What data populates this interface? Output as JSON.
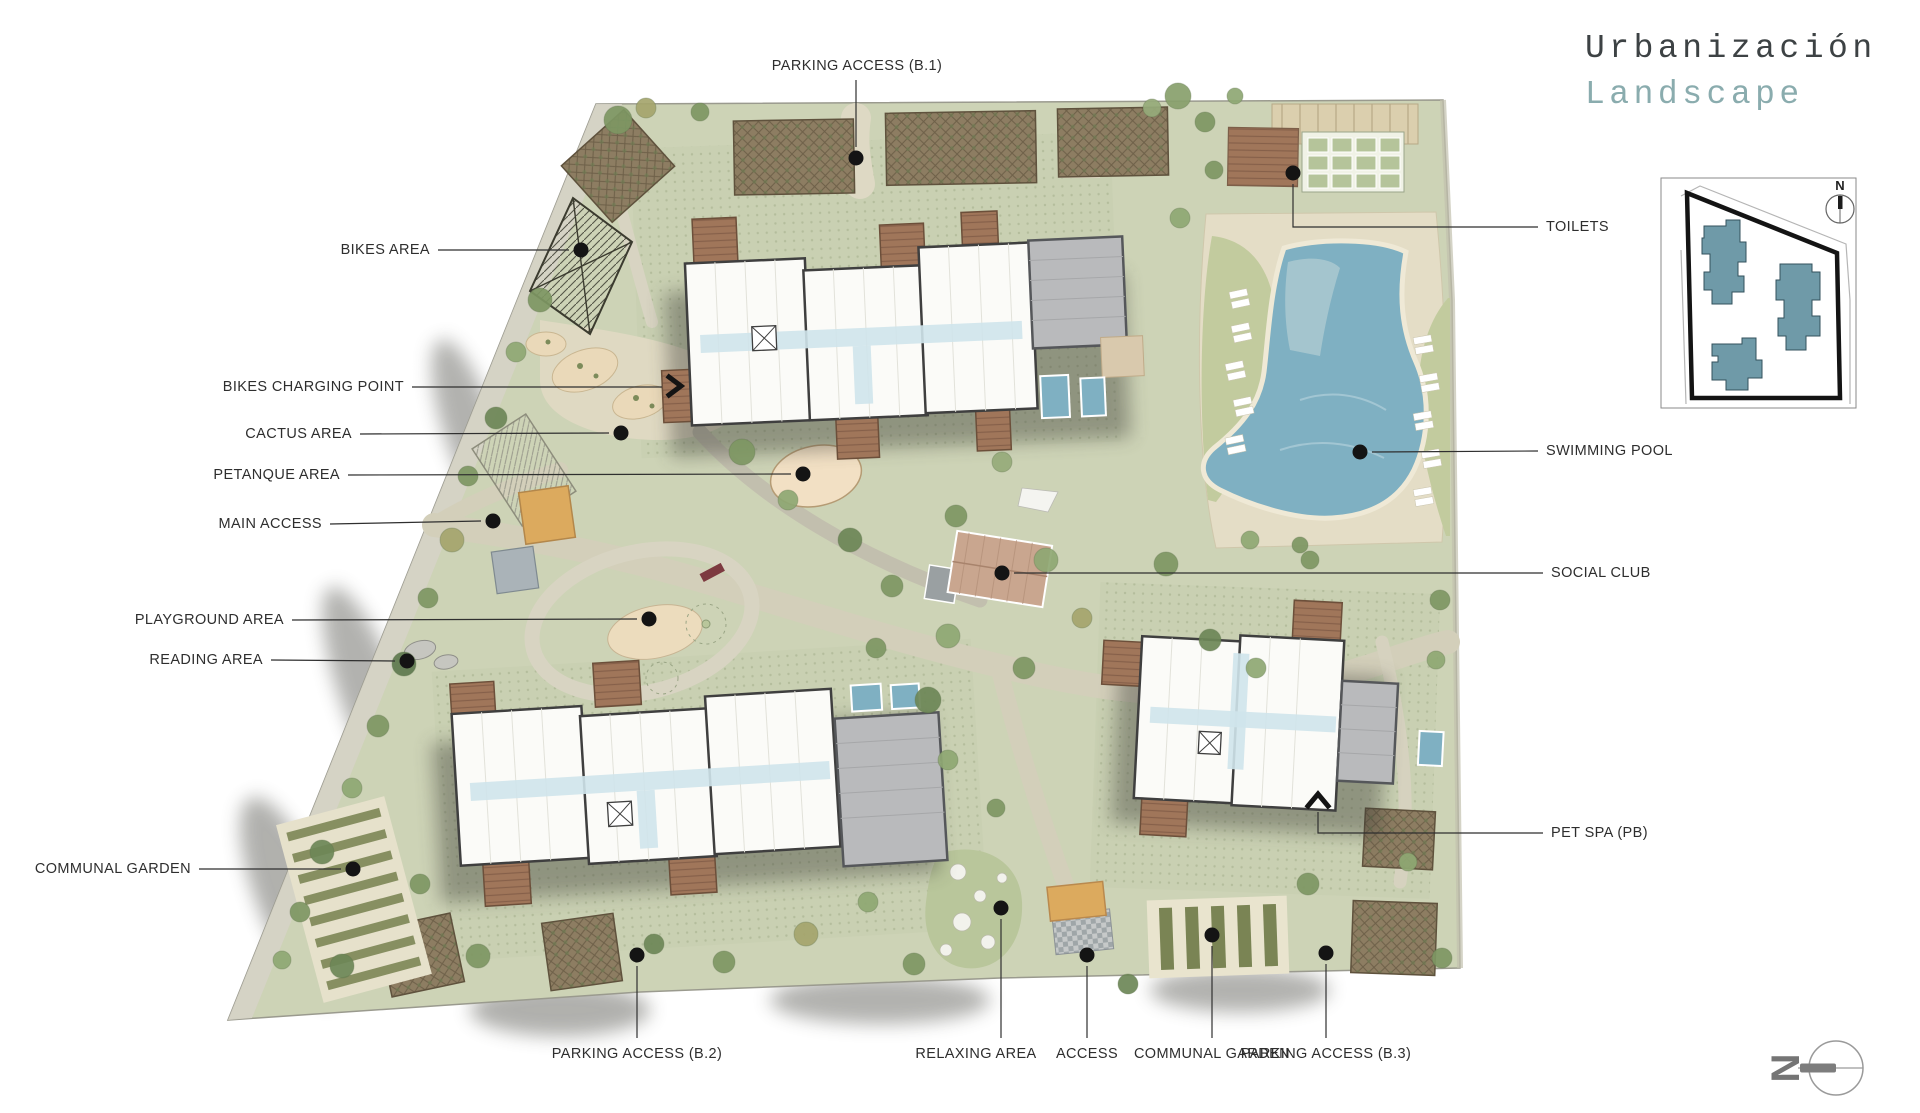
{
  "title": {
    "line1": "Urbanización",
    "line2": "Landscape"
  },
  "palette": {
    "label_color": "#2e2e2e",
    "title_dark": "#3d4244",
    "title_teal": "#8aacae",
    "site_green": "#cdd3b6",
    "lawn": "#c2cb9e",
    "path_beige": "#d8d4c0",
    "pool_blue": "#7fb0c2",
    "building_fill": "#fbfbf8",
    "building_stroke": "#3f3f3f",
    "roof_gray": "#b9babc",
    "terrace_brown": "#9b7258",
    "access_orange": "#dcaa5e",
    "inset_building_teal": "#6f9aa8"
  },
  "inset": {
    "north_label": "N"
  },
  "compass": {
    "north_label": "N"
  },
  "callouts": [
    {
      "id": "parking-access-b1",
      "text": "PARKING ACCESS (B.1)",
      "align": "center",
      "label": [
        857,
        66
      ],
      "line": [
        [
          856,
          80
        ],
        [
          856,
          147
        ]
      ],
      "dot": [
        856,
        158
      ]
    },
    {
      "id": "bikes-area",
      "text": "BIKES AREA",
      "align": "right",
      "label": [
        430,
        250
      ],
      "line": [
        [
          438,
          250
        ],
        [
          569,
          250
        ]
      ],
      "dot": [
        581,
        250
      ]
    },
    {
      "id": "bikes-charging-point",
      "text": "BIKES CHARGING POINT",
      "align": "right",
      "label": [
        404,
        387
      ],
      "line": [
        [
          412,
          387
        ],
        [
          662,
          387
        ]
      ],
      "marker": {
        "type": "chevron-right",
        "x": 676,
        "y": 386
      }
    },
    {
      "id": "cactus-area",
      "text": "CACTUS AREA",
      "align": "right",
      "label": [
        352,
        434
      ],
      "line": [
        [
          360,
          434
        ],
        [
          609,
          433
        ]
      ],
      "dot": [
        621,
        433
      ]
    },
    {
      "id": "petanque-area",
      "text": "PETANQUE AREA",
      "align": "right",
      "label": [
        340,
        475
      ],
      "line": [
        [
          348,
          475
        ],
        [
          791,
          474
        ]
      ],
      "dot": [
        803,
        474
      ]
    },
    {
      "id": "main-access",
      "text": "MAIN ACCESS",
      "align": "right",
      "label": [
        322,
        524
      ],
      "line": [
        [
          330,
          524
        ],
        [
          481,
          521
        ]
      ],
      "dot": [
        493,
        521
      ]
    },
    {
      "id": "playground-area",
      "text": "PLAYGROUND AREA",
      "align": "right",
      "label": [
        284,
        620
      ],
      "line": [
        [
          292,
          620
        ],
        [
          637,
          619
        ]
      ],
      "dot": [
        649,
        619
      ]
    },
    {
      "id": "reading-area",
      "text": "READING AREA",
      "align": "right",
      "label": [
        263,
        660
      ],
      "line": [
        [
          271,
          660
        ],
        [
          395,
          661
        ]
      ],
      "dot": [
        407,
        661
      ]
    },
    {
      "id": "communal-garden-left",
      "text": "COMMUNAL GARDEN",
      "align": "right",
      "label": [
        191,
        869
      ],
      "line": [
        [
          199,
          869
        ],
        [
          341,
          869
        ]
      ],
      "dot": [
        353,
        869
      ]
    },
    {
      "id": "toilets",
      "text": "TOILETS",
      "align": "left",
      "label": [
        1546,
        227
      ],
      "line": [
        [
          1293,
          184
        ],
        [
          1293,
          227
        ],
        [
          1538,
          227
        ]
      ],
      "dot": [
        1293,
        173
      ]
    },
    {
      "id": "swimming-pool",
      "text": "SWIMMING POOL",
      "align": "left",
      "label": [
        1546,
        451
      ],
      "line": [
        [
          1372,
          452
        ],
        [
          1538,
          451
        ]
      ],
      "dot": [
        1360,
        452
      ]
    },
    {
      "id": "social-club",
      "text": "SOCIAL CLUB",
      "align": "left",
      "label": [
        1551,
        573
      ],
      "line": [
        [
          1014,
          573
        ],
        [
          1543,
          573
        ]
      ],
      "dot": [
        1002,
        573
      ]
    },
    {
      "id": "pet-spa",
      "text": "PET SPA (PB)",
      "align": "left",
      "label": [
        1551,
        833
      ],
      "line": [
        [
          1318,
          812
        ],
        [
          1318,
          833
        ],
        [
          1543,
          833
        ]
      ],
      "marker": {
        "type": "chevron-up",
        "x": 1318,
        "y": 800
      }
    },
    {
      "id": "parking-access-b2",
      "text": "PARKING ACCESS (B.2)",
      "align": "center",
      "label": [
        637,
        1054
      ],
      "line": [
        [
          637,
          1038
        ],
        [
          637,
          966
        ]
      ],
      "dot": [
        637,
        955
      ]
    },
    {
      "id": "relaxing-area",
      "text": "RELAXING AREA",
      "align": "center",
      "label": [
        976,
        1054
      ],
      "line": [
        [
          1001,
          1038
        ],
        [
          1001,
          919
        ]
      ],
      "dot": [
        1001,
        908
      ]
    },
    {
      "id": "access",
      "text": "ACCESS",
      "align": "center",
      "label": [
        1087,
        1054
      ],
      "line": [
        [
          1087,
          1038
        ],
        [
          1087,
          966
        ]
      ],
      "dot": [
        1087,
        955
      ]
    },
    {
      "id": "communal-garden-bottom",
      "text": "COMMUNAL GARDEN",
      "align": "center",
      "label": [
        1212,
        1054
      ],
      "line": [
        [
          1212,
          1038
        ],
        [
          1212,
          946
        ]
      ],
      "dot": [
        1212,
        935
      ]
    },
    {
      "id": "parking-access-b3",
      "text": "PARKING ACCESS (B.3)",
      "align": "center",
      "label": [
        1326,
        1054
      ],
      "line": [
        [
          1326,
          1038
        ],
        [
          1326,
          964
        ]
      ],
      "dot": [
        1326,
        953
      ]
    }
  ]
}
